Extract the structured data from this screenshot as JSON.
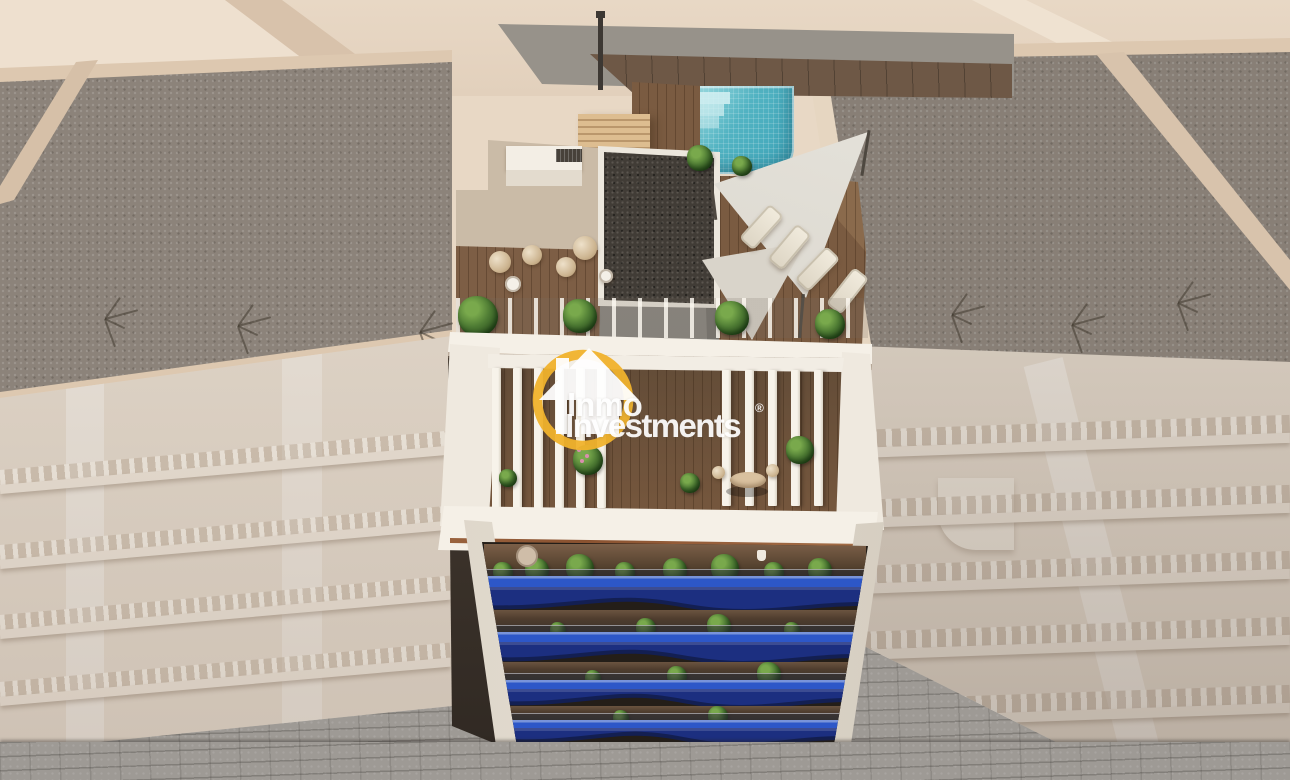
{
  "watermark": {
    "line1": "Inmo",
    "line2": "Investments",
    "registered": "®"
  },
  "colors": {
    "ground_beige": "#e8d8c5",
    "ground_plateau": "#eee0cf",
    "ground_slope": "#d8c2ab",
    "ground_path": "#efe2d1",
    "parapet_beige": "#ddc8b0",
    "roof_gravel": "#8c837a",
    "facade_wash": "#e6dccf",
    "facade_shadow": "#b9aea4",
    "street_gray": "#9e9a95",
    "building_white": "#f5f0e7",
    "pool_turquoise": "#52b3c2",
    "pool_light": "#9bdce1",
    "pool_deep": "#3da4b8",
    "deck_wood": "#7a5b41",
    "deck_wood_dark": "#5f452f",
    "wood_floor": "#7b5a3f",
    "pergola_wood": "#ddbd90",
    "cabinet_wood": "#c9a376",
    "core_gray": "#93908a",
    "core_gray_dark": "#7f7b75",
    "core_roof_dark": "#413c36",
    "sail_light": "#eceae3",
    "sail_shade": "#d9d4ca",
    "balcony_blue_top": "#2d57c8",
    "balcony_blue_front": "#1c2f80",
    "balcony_blue_deep": "#131f52",
    "plant_green": "#4d7a33",
    "plant_green_dark": "#2c501f",
    "plant_green_light": "#79a94c",
    "wicker": "#cdb591",
    "copper": "#bb8158",
    "logo_yellow": "#f0b22c",
    "text_white": "#ffffff",
    "interior_dark": "#3a322b",
    "gap_shadow": "#2f2822"
  },
  "scene": {
    "antenna_clusters": [
      {
        "x": 105,
        "y": 318
      },
      {
        "x": 238,
        "y": 325
      },
      {
        "x": 420,
        "y": 331
      },
      {
        "x": 952,
        "y": 314
      },
      {
        "x": 1072,
        "y": 324
      },
      {
        "x": 1178,
        "y": 302
      }
    ],
    "rooftop_bushes": [
      {
        "x": 478,
        "y": 316,
        "r": 20
      },
      {
        "x": 580,
        "y": 316,
        "r": 17
      },
      {
        "x": 732,
        "y": 318,
        "r": 17
      },
      {
        "x": 830,
        "y": 324,
        "r": 15
      },
      {
        "x": 700,
        "y": 158,
        "r": 13
      },
      {
        "x": 742,
        "y": 166,
        "r": 10
      }
    ],
    "terrace_chairs": [
      {
        "x": 500,
        "y": 262,
        "r": 11
      },
      {
        "x": 532,
        "y": 255,
        "r": 10
      },
      {
        "x": 566,
        "y": 267,
        "r": 10
      },
      {
        "x": 585,
        "y": 248,
        "r": 12
      }
    ],
    "terrace_tables": [
      {
        "x": 513,
        "y": 284,
        "r": 8
      },
      {
        "x": 606,
        "y": 276,
        "r": 7
      }
    ],
    "loungers": [
      {
        "x": 752,
        "y": 204,
        "rot": 42
      },
      {
        "x": 780,
        "y": 224,
        "rot": 40
      },
      {
        "x": 808,
        "y": 246,
        "rot": 44
      },
      {
        "x": 838,
        "y": 268,
        "rot": 38
      }
    ],
    "slat_groups": [
      {
        "x": 492,
        "y": 368,
        "count": 6,
        "gap": 21,
        "w": 9,
        "h": 140
      },
      {
        "x": 722,
        "y": 370,
        "count": 5,
        "gap": 23,
        "w": 9,
        "h": 136
      }
    ],
    "mid_plants": [
      {
        "x": 588,
        "y": 460,
        "r": 15,
        "flower": true
      },
      {
        "x": 800,
        "y": 450,
        "r": 14
      },
      {
        "x": 690,
        "y": 483,
        "r": 10
      },
      {
        "x": 508,
        "y": 478,
        "r": 9
      }
    ],
    "floors": [
      {
        "interior": {
          "x": 484,
          "y": 544,
          "w": 382,
          "h": 32
        },
        "band": {
          "x": 486,
          "y": 576,
          "w": 377,
          "h": 34
        },
        "plants": [
          0.05,
          0.14,
          0.25,
          0.37,
          0.5,
          0.63,
          0.76,
          0.88
        ]
      },
      {
        "interior": {
          "x": 492,
          "y": 610,
          "w": 366,
          "h": 22
        },
        "band": {
          "x": 494,
          "y": 632,
          "w": 363,
          "h": 30
        },
        "plants": [
          0.18,
          0.42,
          0.62,
          0.82
        ]
      },
      {
        "interior": {
          "x": 501,
          "y": 662,
          "w": 352,
          "h": 18
        },
        "band": {
          "x": 503,
          "y": 680,
          "w": 348,
          "h": 26
        },
        "plants": [
          0.26,
          0.5,
          0.76
        ]
      },
      {
        "interior": {
          "x": 510,
          "y": 706,
          "w": 336,
          "h": 14
        },
        "band": {
          "x": 512,
          "y": 720,
          "w": 332,
          "h": 24
        },
        "plants": [
          0.33,
          0.62
        ]
      }
    ],
    "attic_items": [
      {
        "type": "disc",
        "x": 527,
        "y": 556,
        "r": 11
      },
      {
        "type": "pot",
        "x": 757,
        "y": 550
      }
    ],
    "left_facade_rows": [
      470,
      545,
      615,
      682
    ],
    "right_facade_rows": [
      430,
      500,
      566,
      632,
      700
    ]
  }
}
